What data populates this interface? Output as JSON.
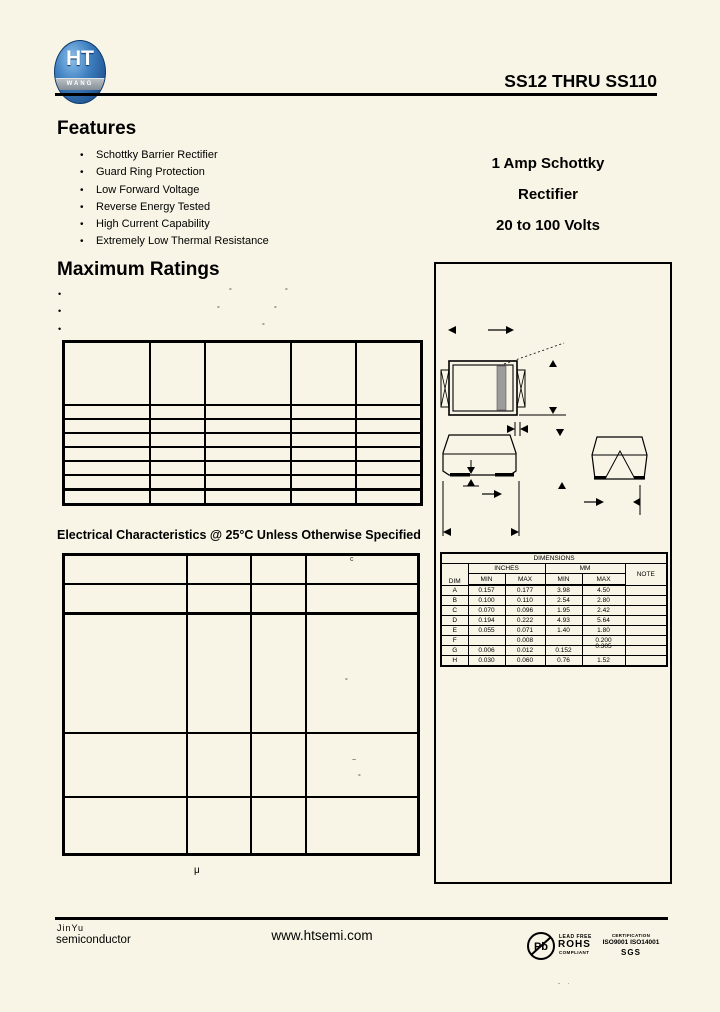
{
  "page": {
    "title": "SS12 THRU SS110",
    "page_mark": "- ·"
  },
  "logo": {
    "main": "HT",
    "band": "WANG",
    "tiny": "·····"
  },
  "features": {
    "heading": "Features",
    "items": [
      "Schottky Barrier Rectifier",
      "Guard Ring Protection",
      "Low Forward Voltage",
      "Reverse Energy Tested",
      "High Current Capability",
      "Extremely Low Thermal Resistance"
    ]
  },
  "summary": {
    "line1": "1 Amp Schottky",
    "line2": "Rectifier",
    "line3": "20 to 100 Volts"
  },
  "max_ratings": {
    "heading": "Maximum Ratings",
    "stray": {
      "b1a": "°",
      "b1b": "°",
      "b2a": "°",
      "b2b": "°",
      "b3a": "°"
    }
  },
  "elec": {
    "heading": "Electrical Characteristics @ 25°C Unless Otherwise Specified",
    "stray": {
      "h": "c",
      "r1": "°",
      "r2a": "~",
      "r2b": "°"
    },
    "below": "μ"
  },
  "dims_table": {
    "title": "DIMENSIONS",
    "dim": "DIM",
    "inches": "INCHES",
    "mm": "MM",
    "min": "MIN",
    "max": "MAX",
    "note": "NOTE",
    "rows": [
      {
        "dim": "A",
        "in_min": "0.157",
        "in_max": "0.177",
        "mm_min": "3.98",
        "mm_max": "4.50",
        "note": ""
      },
      {
        "dim": "B",
        "in_min": "0.100",
        "in_max": "0.110",
        "mm_min": "2.54",
        "mm_max": "2.80",
        "note": ""
      },
      {
        "dim": "C",
        "in_min": "0.070",
        "in_max": "0.096",
        "mm_min": "1.95",
        "mm_max": "2.42",
        "note": ""
      },
      {
        "dim": "D",
        "in_min": "0.194",
        "in_max": "0.222",
        "mm_min": "4.93",
        "mm_max": "5.64",
        "note": ""
      },
      {
        "dim": "E",
        "in_min": "0.055",
        "in_max": "0.071",
        "mm_min": "1.40",
        "mm_max": "1.80",
        "note": ""
      },
      {
        "dim": "F",
        "in_min": "",
        "in_max": "0.008",
        "mm_min": "",
        "mm_max": "0.200",
        "note": ""
      },
      {
        "dim": "G",
        "in_min": "0.006",
        "in_max": "0.012",
        "mm_min": "0.152",
        "mm_max": "0.305",
        "note": ""
      },
      {
        "dim": "H",
        "in_min": "0.030",
        "in_max": "0.060",
        "mm_min": "0.76",
        "mm_max": "1.52",
        "note": ""
      }
    ]
  },
  "footer": {
    "company1": "JinYu",
    "company2": "semiconductor",
    "website": "www.htsemi.com",
    "pb": "Pb",
    "lead_free": "LEAD FREE",
    "rohs": "ROHS",
    "compliant": "COMPLIANT",
    "certification": "CERTIFICATION",
    "iso": "ISO9001  ISO14001",
    "sgs": "SGS"
  }
}
